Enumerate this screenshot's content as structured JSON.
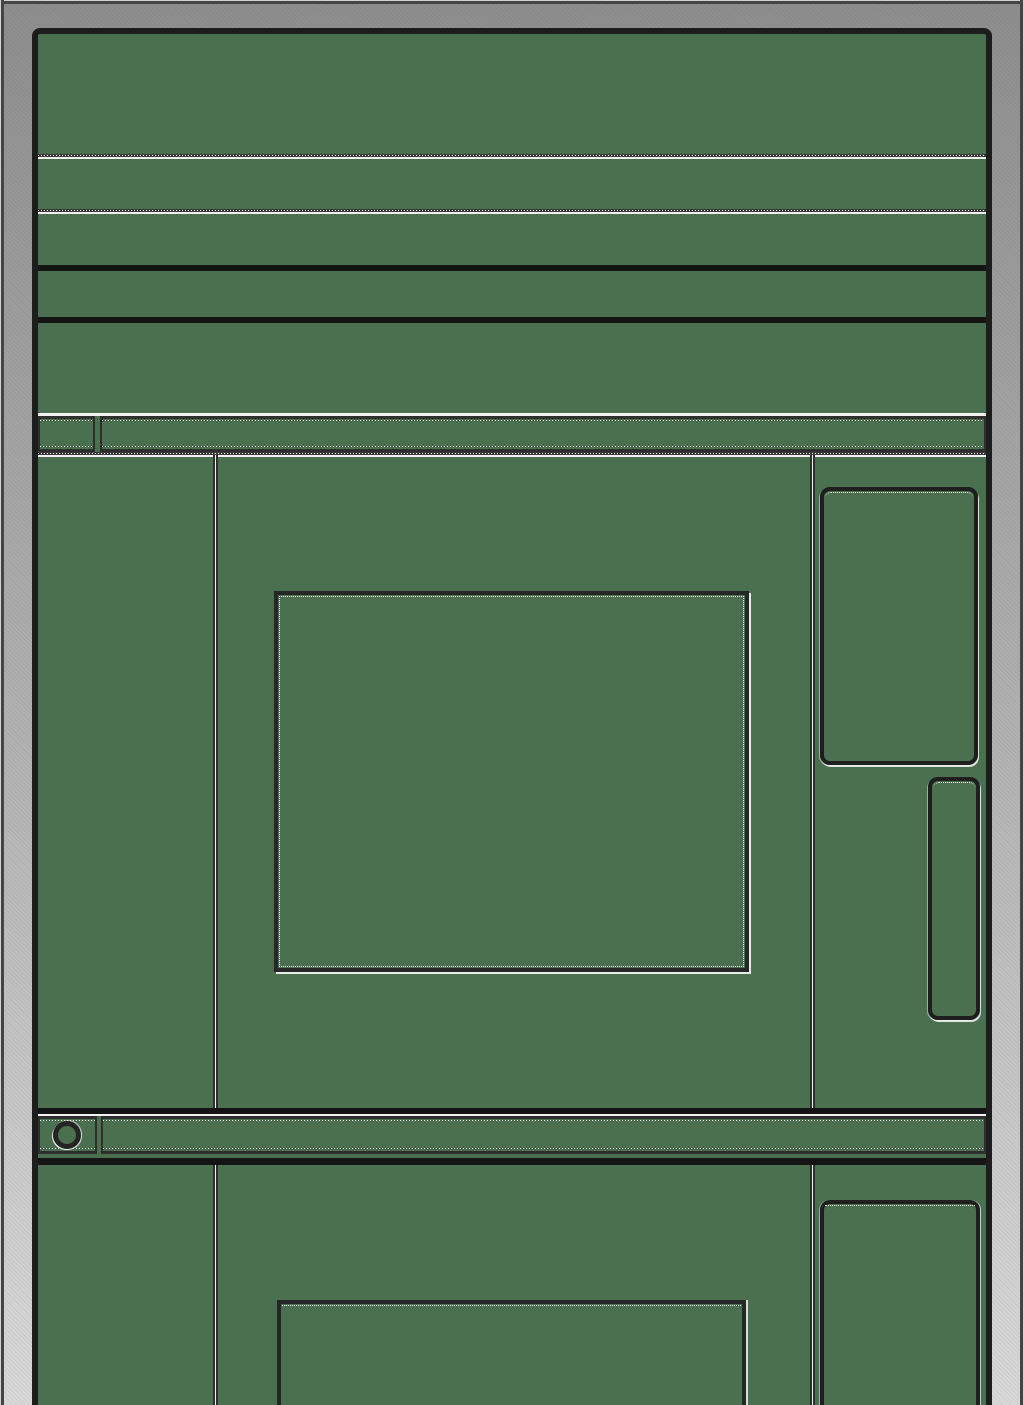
{
  "theme": {
    "frame_top": "#8E8E8E",
    "frame_bottom": "#D9D9D9",
    "frame_edge_dark": "#454545",
    "frame_edge_light": "#D2D2D2",
    "window_border": "#1D1D1D",
    "content_bg": "#4A7050",
    "line_dark": "#2E2E2E",
    "line_black": "#141414",
    "line_white": "#F2F2F2",
    "icon_ring": "#242424"
  },
  "icons": {
    "status_indicator_shape": "hollow-circle"
  }
}
